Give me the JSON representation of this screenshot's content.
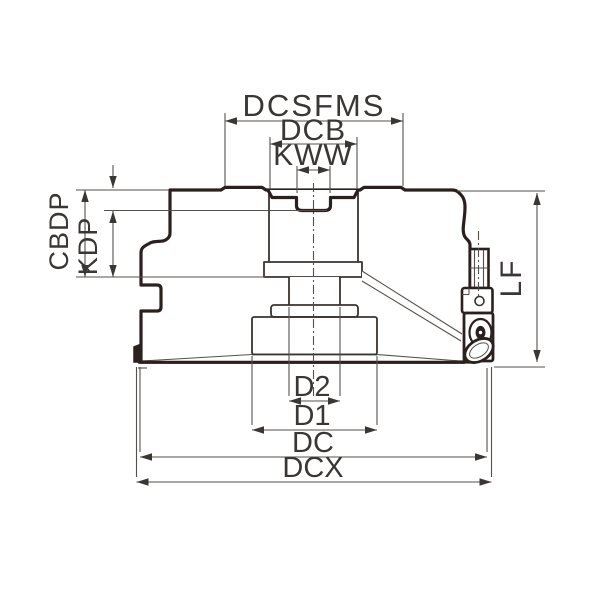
{
  "diagram": {
    "type": "engineering-dimension-drawing",
    "subject": "face-milling-cutter-cross-section",
    "dimension_labels": {
      "dcsfms": "DCSFMS",
      "dcb": "DCB",
      "kww": "KWW",
      "cbdp": "CBDP",
      "kdp": "KDP",
      "lf": "LF",
      "d2": "D2",
      "d1": "D1",
      "dc": "DC",
      "dcx": "DCX"
    },
    "colors": {
      "background": "#ffffff",
      "body_fill": "#ececec",
      "outline": "#2a211e",
      "medium_line": "#3a3330",
      "thin_line": "#56504b",
      "label_text": "#3a3634"
    }
  }
}
